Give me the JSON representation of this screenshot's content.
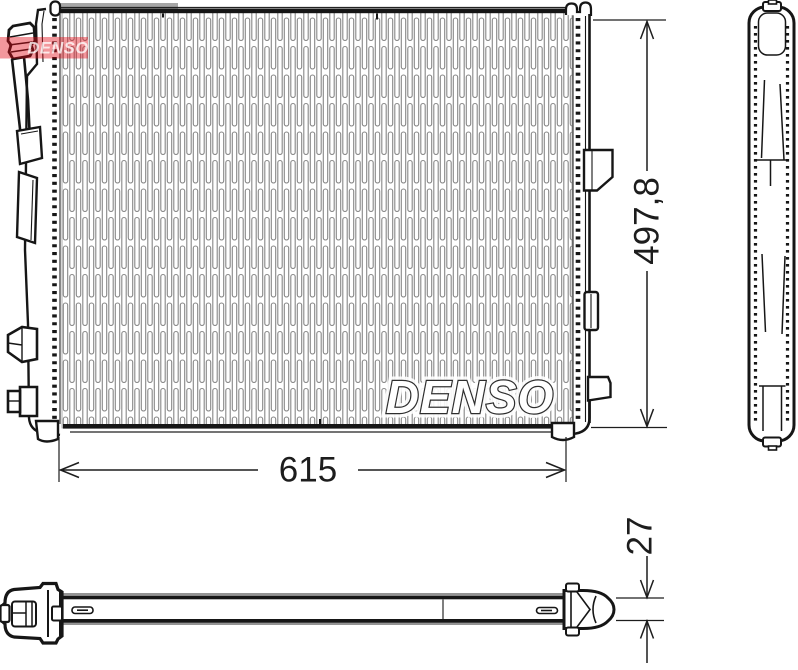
{
  "drawing": {
    "watermark": "DENSO",
    "corner_logo": "DENSO",
    "dimensions": {
      "height": "497,8",
      "width": "615",
      "depth": "27"
    },
    "colors": {
      "denso_red": "#e30613",
      "line": "#161616",
      "hatch": "#878787"
    }
  }
}
